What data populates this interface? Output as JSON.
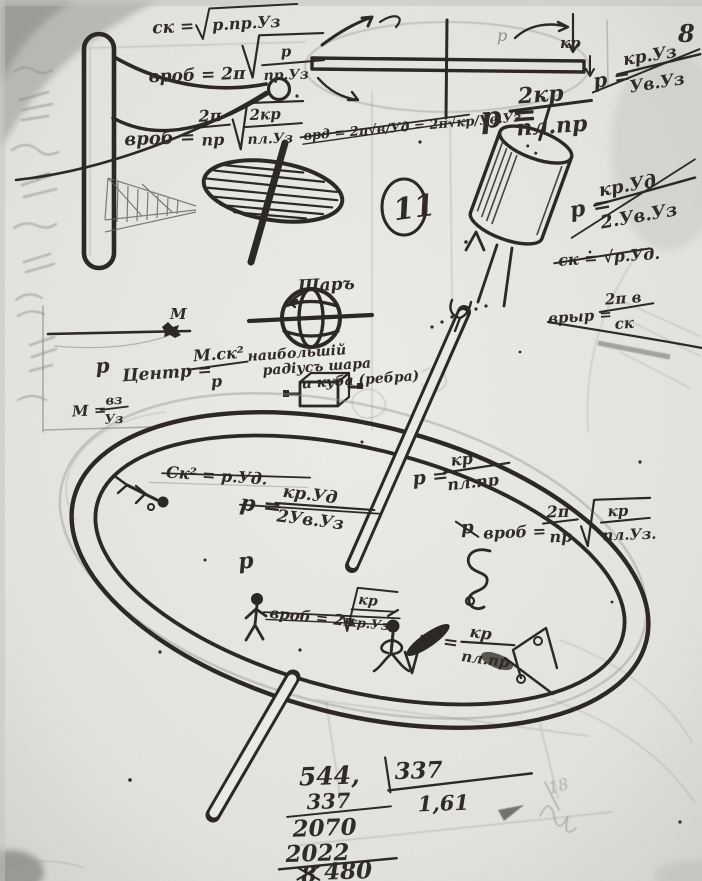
{
  "page": {
    "corner_number": "8",
    "circled_number": "11",
    "faint_number": "18"
  },
  "labels": {
    "bar_p": "р",
    "bar_kr": "кр",
    "mass_point": "М",
    "sphere_title": "Шаръ",
    "sphere_caption_line1": "наибольшій",
    "sphere_caption_line2": "радіусъ шара",
    "sphere_caption_line3": "и куба (ребра)",
    "ring_label_p": "р"
  },
  "formulas": {
    "f1": {
      "lhs": "ск =",
      "radicand": "р.пр.Уз"
    },
    "f2": {
      "lhs": "вроб = 2π",
      "num": "р",
      "den": "пр.Уз"
    },
    "f3": {
      "lhs": "вроб =",
      "num1": "2π",
      "den1": "пр",
      "num2": "2кр",
      "den2": "пл.Уз"
    },
    "f4": {
      "text": "врд = 2π√в/Уд = 2π√кр/Ув.Уз"
    },
    "f5": {
      "lhs": "р =",
      "num": "2кр",
      "den": "пл.пр"
    },
    "f6": {
      "lhs": "р =",
      "num": "кр.Уз",
      "den": "Ув.Уз"
    },
    "f7": {
      "lhs": "р =",
      "num": "кр.Уд",
      "den": "2.Ув.Уз"
    },
    "f8": {
      "text": "ск = √р.Уд."
    },
    "f9": {
      "lhs": "врыр =",
      "num": "2π в",
      "den": "ск"
    },
    "f10": {
      "pre": "р",
      "lhs": "Центр =",
      "num": "М.ск²",
      "den": "р"
    },
    "f11": {
      "lhs": "М =",
      "num": "вз",
      "den": "Уз"
    },
    "f12": {
      "text": "Ск² = р.Уд."
    },
    "f13": {
      "lhs": "р =",
      "num": "кр.Уд",
      "den": "2Ув.Уз"
    },
    "f14": {
      "lhs": "р =",
      "num": "кр",
      "den": "пл.пр"
    },
    "f15": {
      "pre": "р",
      "lhs": "вроб =",
      "num1": "2π",
      "den1": "пр",
      "num2": "кр",
      "den2": "пл.Уз."
    },
    "f16": {
      "lhs": "вроб = 2π",
      "num": "кр",
      "den": "кр.Уз"
    },
    "f17": {
      "lhs": "=",
      "num": "кр",
      "den": "пл.пр"
    }
  },
  "calculation": {
    "dividend": "544,",
    "divisor": "337",
    "row2": "337",
    "quotient": "1,61",
    "row3": "2070",
    "row4": "2022",
    "struck_digit": "8",
    "result": "480"
  }
}
